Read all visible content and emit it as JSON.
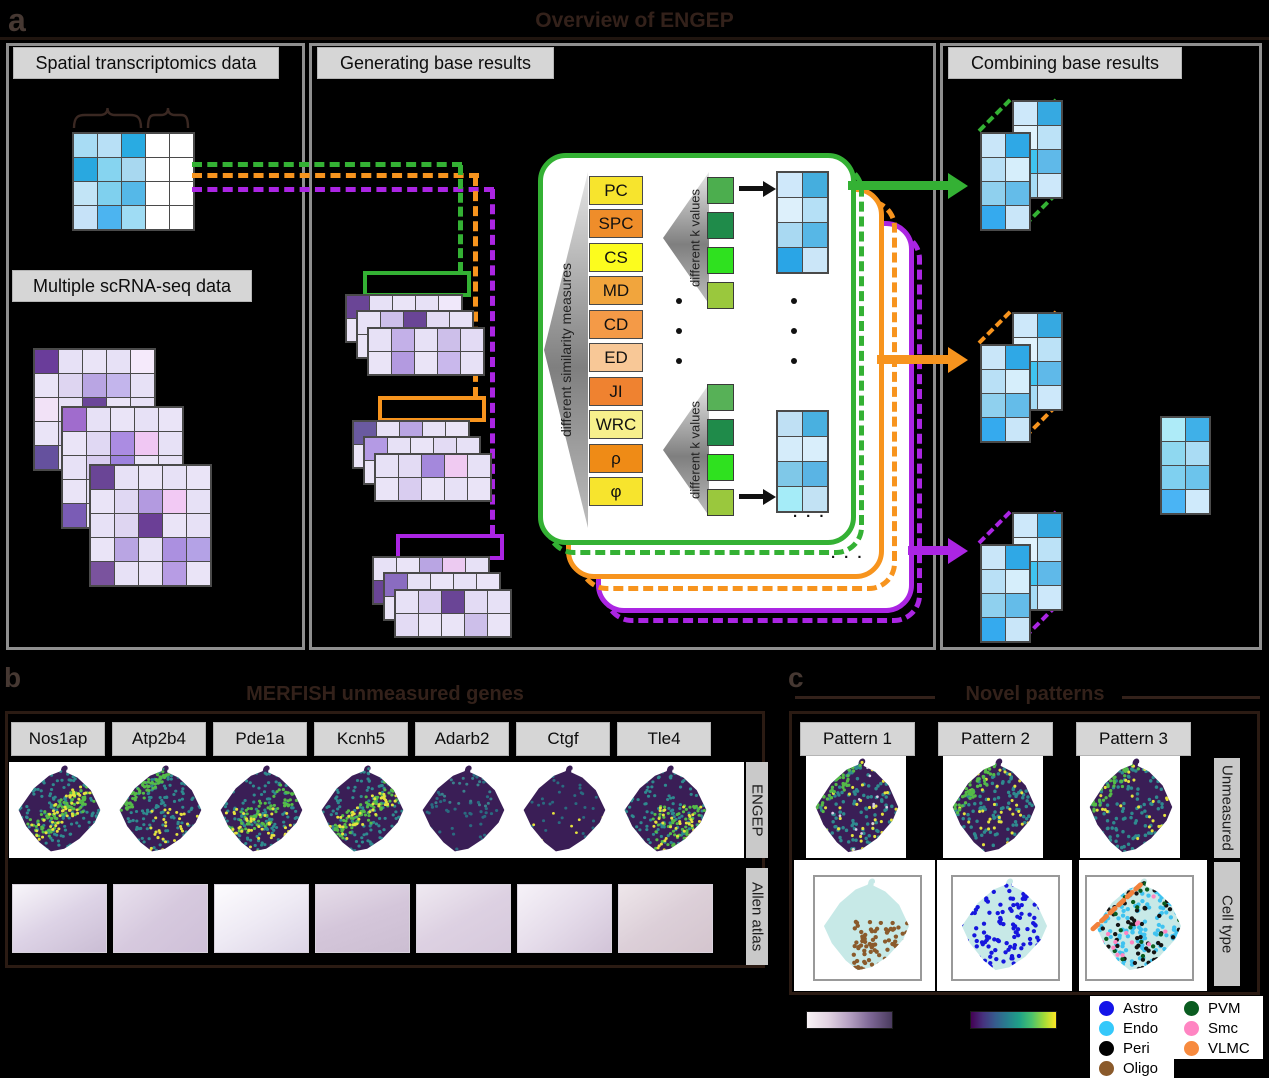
{
  "figure": {
    "tag_a": "a",
    "tag_b": "b",
    "tag_c": "c",
    "title": "Overview of ENGEP"
  },
  "colors": {
    "green": "#34b134",
    "orange": "#f7941e",
    "purple": "#ab25e3",
    "black": "#111111"
  },
  "panel_a": {
    "spatial_label": "Spatial transcriptomics data",
    "scrna_label": "Multiple scRNA-seq data",
    "generating_label": "Generating base results",
    "combining_label": "Combining base results",
    "similarity_label": "different similarity measures",
    "k_label": "different k values",
    "ellipsis": "· · ·",
    "measures": [
      {
        "label": "PC",
        "color": "#f7e42d"
      },
      {
        "label": "SPC",
        "color": "#ef8d2a"
      },
      {
        "label": "CS",
        "color": "#fcfc1e"
      },
      {
        "label": "MD",
        "color": "#f1a53d"
      },
      {
        "label": "CD",
        "color": "#f49a47"
      },
      {
        "label": "ED",
        "color": "#f8c897"
      },
      {
        "label": "JI",
        "color": "#ef8230"
      },
      {
        "label": "WRC",
        "color": "#f7f08c"
      },
      {
        "label": "ρ",
        "color": "#ef8b16"
      },
      {
        "label": "φ",
        "color": "#f7e42d"
      }
    ],
    "k_colors1": [
      "#4cae4e",
      "#1f8b4a",
      "#2fe11f",
      "#9ac83d"
    ],
    "k_colors2": [
      "#57b157",
      "#1f8b4a",
      "#2fe11f",
      "#9ac83d"
    ],
    "spatial_grid": [
      [
        "#a8dcf4",
        "#b8e0f6",
        "#29abe2",
        "#ffffff",
        "#ffffff"
      ],
      [
        "#29a8e0",
        "#86d4f0",
        "#a8d8f0",
        "#ffffff",
        "#ffffff"
      ],
      [
        "#c2e4f6",
        "#7fd0ee",
        "#55b8e8",
        "#ffffff",
        "#ffffff"
      ],
      [
        "#c6e2f8",
        "#4cb4f0",
        "#9fdcf4",
        "#ffffff",
        "#ffffff"
      ]
    ],
    "scrna_grids": [
      [
        [
          "#6a3d9a",
          "#e7e1f6",
          "#eae4f7",
          "#e7e1f6",
          "#f5eafb"
        ],
        [
          "#eae4f7",
          "#ded5f1",
          "#b9a5e3",
          "#c3b5ec",
          "#e7e1f6"
        ],
        [
          "#f2e2f7",
          "#e7e1f6",
          "#6b4699",
          "#eae4f7",
          "#e7e1f6"
        ],
        [
          "#eae4f7",
          "#ded5f1",
          "#e7e1f6",
          "#eae4f7",
          "#e7e1f6"
        ],
        [
          "#65519e",
          "#e7e1f6",
          "#ded5f1",
          "#eae4f7",
          "#e7e1f6"
        ]
      ],
      [
        [
          "#a06ccd",
          "#e7e1f6",
          "#eae4f7",
          "#e7e1f6",
          "#eae4f7"
        ],
        [
          "#eae4f7",
          "#e0d8f3",
          "#ab8ce2",
          "#f0c7f3",
          "#e7e1f6"
        ],
        [
          "#e7e1f6",
          "#d9cdf0",
          "#9d82de",
          "#eae4f7",
          "#e7e1f6"
        ],
        [
          "#eae4f7",
          "#e7e1f6",
          "#e0d8f3",
          "#eae4f7",
          "#ded5f1"
        ],
        [
          "#7a5cb5",
          "#eae4f7",
          "#e7e1f6",
          "#e0d8f3",
          "#eae4f7"
        ]
      ],
      [
        [
          "#6a4596",
          "#e7e1f6",
          "#eae4f7",
          "#e7e1f6",
          "#eae4f7"
        ],
        [
          "#eae4f7",
          "#e0d8f3",
          "#b39ae0",
          "#f2c9f4",
          "#e7e1f6"
        ],
        [
          "#e7e1f6",
          "#ded5f1",
          "#6b3f96",
          "#eae4f7",
          "#e7e1f6"
        ],
        [
          "#eae4f7",
          "#b9a5e3",
          "#e7e1f6",
          "#ab90e0",
          "#b4a2e6"
        ],
        [
          "#7a539e",
          "#e7e1f6",
          "#eae4f7",
          "#b79ce4",
          "#eae4f7"
        ]
      ]
    ],
    "gen_groups": {
      "green": [
        [
          [
            "#6a4596",
            "#e7e1f6",
            "#eae4f7",
            "#e7e1f6",
            "#f0e8fa"
          ],
          [
            "#eae4f7",
            "#d9cdf0",
            "#7a5cb5",
            "#e7e1f6",
            "#eae4f7"
          ]
        ],
        [
          [
            "#e7e1f6",
            "#cdbfea",
            "#6a4596",
            "#e3dbf4",
            "#e7e1f6"
          ],
          [
            "#eae4f7",
            "#b9a5e3",
            "#e7e1f6",
            "#d3c5ee",
            "#eae4f7"
          ]
        ],
        [
          [
            "#e7e1f6",
            "#c3b0e8",
            "#e7e1f6",
            "#cdbfea",
            "#e3dbf4"
          ],
          [
            "#eae4f7",
            "#b39ae0",
            "#eae4f7",
            "#c9b8ec",
            "#e7e1f6"
          ]
        ]
      ],
      "orange": [
        [
          [
            "#6a5aa0",
            "#e7e1f6",
            "#b9a5e3",
            "#e7e1f6",
            "#eae4f7"
          ],
          [
            "#eae4f7",
            "#e3dbf4",
            "#b09ae0",
            "#eae4f7",
            "#e7e1f6"
          ]
        ],
        [
          [
            "#b49ae4",
            "#e7e1f6",
            "#eae4f7",
            "#e3dbf4",
            "#e7e1f6"
          ],
          [
            "#eae4f7",
            "#e7e1f6",
            "#e3dbf4",
            "#eae4f7",
            "#eae4f7"
          ]
        ],
        [
          [
            "#e7e1f6",
            "#e3dbf4",
            "#a488dc",
            "#f0caf2",
            "#e7e1f6"
          ],
          [
            "#eae4f7",
            "#d9cdf0",
            "#eae4f7",
            "#e7e1f6",
            "#eae4f7"
          ]
        ]
      ],
      "purple": [
        [
          [
            "#e7e1f6",
            "#eae4f7",
            "#b9a5e3",
            "#eccaf1",
            "#e7e1f6"
          ],
          [
            "#6a4596",
            "#e3dbf4",
            "#eae4f7",
            "#e7e1f6",
            "#eae4f7"
          ]
        ],
        [
          [
            "#8a6cc0",
            "#e7e1f6",
            "#eae4f7",
            "#e7e1f6",
            "#eae4f7"
          ],
          [
            "#eae4f7",
            "#e3dbf4",
            "#6a4596",
            "#e7e1f6",
            "#eae4f7"
          ]
        ],
        [
          [
            "#e7e1f6",
            "#d9cdf0",
            "#6a4596",
            "#e3dbf4",
            "#e7e1f6"
          ],
          [
            "#e3dbf4",
            "#eae4f7",
            "#eae4f7",
            "#cdbfea",
            "#eae4f7"
          ]
        ]
      ]
    },
    "result_grids": [
      [
        [
          "#cfe8fa",
          "#45aede"
        ],
        [
          "#ddf0fb",
          "#b5e0f6"
        ],
        [
          "#a9d9f2",
          "#57b7e6"
        ],
        [
          "#2aa5e6",
          "#cbe6f8"
        ]
      ],
      [
        [
          "#bfe0f4",
          "#49b0e0"
        ],
        [
          "#d5ecfa",
          "#d9eefb"
        ],
        [
          "#7fc8e8",
          "#5ab4e4"
        ],
        [
          "#a5ecf8",
          "#c2e2f4"
        ]
      ]
    ],
    "combine": {
      "back": [
        [
          "#cde8fa",
          "#36a9e1"
        ],
        [
          "#e0f2fc",
          "#bce2f7"
        ],
        [
          "#3fc4f0",
          "#5fb9e9"
        ],
        [
          "#a7dcf5",
          "#cde8fa"
        ]
      ],
      "front": [
        [
          "#c9e6f9",
          "#2fa8e6"
        ],
        [
          "#b9e0f6",
          "#d6eefb"
        ],
        [
          "#8fd0ee",
          "#64bce9"
        ],
        [
          "#35aaee",
          "#c9e6f9"
        ]
      ],
      "standalone": [
        [
          "#aeebf8",
          "#3fb0e8"
        ],
        [
          "#8fd8f0",
          "#aadcf4"
        ],
        [
          "#7fd0f0",
          "#6cc4ec"
        ],
        [
          "#4ab4f4",
          "#cfeafb"
        ]
      ]
    }
  },
  "panel_b": {
    "title": "MERFISH unmeasured genes",
    "genes": [
      {
        "name": "Nos1ap"
      },
      {
        "name": "Atp2b4"
      },
      {
        "name": "Pde1a"
      },
      {
        "name": "Kcnh5"
      },
      {
        "name": "Adarb2"
      },
      {
        "name": "Ctgf"
      },
      {
        "name": "Tle4"
      }
    ],
    "row1_label": "ENGEP",
    "row2_label": "Allen atlas"
  },
  "panel_c": {
    "title": "Novel patterns",
    "patterns": [
      {
        "name": "Pattern 1"
      },
      {
        "name": "Pattern 2"
      },
      {
        "name": "Pattern 3"
      }
    ],
    "row1_label": "Unmeasured",
    "row2_label": "Cell type"
  },
  "legend": {
    "items": [
      {
        "label": "Astro",
        "color": "#1414e8"
      },
      {
        "label": "Endo",
        "color": "#35c8fa"
      },
      {
        "label": "Peri",
        "color": "#000000"
      },
      {
        "label": "Oligo",
        "color": "#8a5a2b"
      },
      {
        "label": "PVM",
        "color": "#0a5c20"
      },
      {
        "label": "Smc",
        "color": "#ff85c2"
      },
      {
        "label": "VLMC",
        "color": "#f78a3e"
      }
    ]
  },
  "colorbars": {
    "expression": [
      "#f9f3f6",
      "#e2d3e2",
      "#b5a0c2",
      "#7c6694",
      "#4a3b5f"
    ],
    "viridis": [
      "#440154",
      "#46327e",
      "#365c8d",
      "#277f8e",
      "#1fa187",
      "#4ac16d",
      "#a0da39",
      "#fde725"
    ]
  },
  "maps": {
    "engep": [
      {
        "seed": 1,
        "base": "#3a1e56",
        "layers": [
          {
            "c": "#2f8a8f",
            "n": 200,
            "rg": "all",
            "r": 1.7
          },
          {
            "c": "#55bb48",
            "n": 90,
            "rg": "diag",
            "r": 1.7
          },
          {
            "c": "#e5e33e",
            "n": 60,
            "rg": "diag",
            "r": 1.6
          }
        ]
      },
      {
        "seed": 2,
        "base": "#3a1e56",
        "layers": [
          {
            "c": "#2f8a8f",
            "n": 200,
            "rg": "all",
            "r": 1.7
          },
          {
            "c": "#55bb48",
            "n": 80,
            "rg": "edgeTL",
            "r": 1.7
          },
          {
            "c": "#e5e33e",
            "n": 50,
            "rg": "lowerRight",
            "r": 1.6
          }
        ]
      },
      {
        "seed": 3,
        "base": "#3a1e56",
        "layers": [
          {
            "c": "#2f8a8f",
            "n": 190,
            "rg": "all",
            "r": 1.7
          },
          {
            "c": "#55bb48",
            "n": 80,
            "rg": "diag",
            "r": 1.7
          },
          {
            "c": "#e5e33e",
            "n": 55,
            "rg": "lower",
            "r": 1.6
          }
        ]
      },
      {
        "seed": 4,
        "base": "#3a1e56",
        "layers": [
          {
            "c": "#2f8a8f",
            "n": 190,
            "rg": "all",
            "r": 1.7
          },
          {
            "c": "#55bb48",
            "n": 85,
            "rg": "diag",
            "r": 1.7
          },
          {
            "c": "#e5e33e",
            "n": 50,
            "rg": "diag",
            "r": 1.6
          }
        ]
      },
      {
        "seed": 5,
        "base": "#3a1e56",
        "layers": [
          {
            "c": "#2a6a80",
            "n": 70,
            "rg": "all",
            "r": 1.7
          },
          {
            "c": "#3a7f8c",
            "n": 35,
            "rg": "upper",
            "r": 1.6
          }
        ]
      },
      {
        "seed": 6,
        "base": "#3a1e56",
        "layers": [
          {
            "c": "#2a6a80",
            "n": 45,
            "rg": "all",
            "r": 1.6
          },
          {
            "c": "#e5e33e",
            "n": 10,
            "rg": "lower",
            "r": 1.5
          }
        ]
      },
      {
        "seed": 7,
        "base": "#3a1e56",
        "layers": [
          {
            "c": "#2f8a8f",
            "n": 140,
            "rg": "all",
            "r": 1.7
          },
          {
            "c": "#55bb48",
            "n": 70,
            "rg": "lowerRight",
            "r": 1.7
          },
          {
            "c": "#e5e33e",
            "n": 55,
            "rg": "lowerRight",
            "r": 1.6
          }
        ]
      }
    ],
    "patterns": [
      {
        "seed": 11,
        "base": "#3a1e56",
        "layers": [
          {
            "c": "#2f8a8f",
            "n": 170,
            "rg": "all",
            "r": 1.8
          },
          {
            "c": "#e5e33e",
            "n": 55,
            "rg": "all",
            "r": 1.6
          },
          {
            "c": "#55bb48",
            "n": 45,
            "rg": "edgeTL",
            "r": 1.7
          },
          {
            "c": "#d8d0e8",
            "n": 18,
            "rg": "all",
            "r": 1.4
          }
        ]
      },
      {
        "seed": 12,
        "base": "#3a1e56",
        "layers": [
          {
            "c": "#2f8a8f",
            "n": 160,
            "rg": "all",
            "r": 1.8
          },
          {
            "c": "#e5e33e",
            "n": 60,
            "rg": "all",
            "r": 1.6
          },
          {
            "c": "#55bb48",
            "n": 55,
            "rg": "edgeTL",
            "r": 1.7
          }
        ]
      },
      {
        "seed": 13,
        "base": "#3a1e56",
        "layers": [
          {
            "c": "#2f8a8f",
            "n": 170,
            "rg": "all",
            "r": 1.8
          },
          {
            "c": "#e5e33e",
            "n": 42,
            "rg": "all",
            "r": 1.6
          },
          {
            "c": "#55bb48",
            "n": 40,
            "rg": "edgeTL",
            "r": 1.7
          }
        ]
      }
    ],
    "celltype": [
      {
        "seed": 21,
        "base": "#c7e9e7",
        "layers": [
          {
            "c": "#8a5a2b",
            "n": 120,
            "rg": "lowerRight",
            "r": 2.2
          }
        ]
      },
      {
        "seed": 22,
        "base": "#c7e9e7",
        "layers": [
          {
            "c": "#1616dd",
            "n": 150,
            "rg": "all",
            "r": 2.2
          }
        ]
      },
      {
        "seed": 23,
        "base": "#c7e9e7",
        "layers": [
          {
            "c": "#3fc3f0",
            "n": 150,
            "rg": "all",
            "r": 2.2
          },
          {
            "c": "#141414",
            "n": 75,
            "rg": "all",
            "r": 2.2
          },
          {
            "c": "#0a5c20",
            "n": 32,
            "rg": "all",
            "r": 2.2
          },
          {
            "c": "#ff85c2",
            "n": 20,
            "rg": "all",
            "r": 2.2
          }
        ],
        "arc": "#f2813c"
      }
    ],
    "allen": [
      {
        "deg": 150,
        "cs": [
          "#f8f6fa",
          "#ddd3e6",
          "#cabdd4"
        ]
      },
      {
        "deg": 140,
        "cs": [
          "#e9e1ee",
          "#d6c9de",
          "#cfc0d8"
        ]
      },
      {
        "deg": 150,
        "cs": [
          "#fdfcfe",
          "#eeeaf4",
          "#dcd4e6"
        ]
      },
      {
        "deg": 160,
        "cs": [
          "#e6dde9",
          "#d4c6da",
          "#ccbed2"
        ]
      },
      {
        "deg": 150,
        "cs": [
          "#efe9f1",
          "#ddd1e2",
          "#d6c9dc"
        ]
      },
      {
        "deg": 140,
        "cs": [
          "#f6f2f8",
          "#e5dcea",
          "#d2c4d8"
        ]
      },
      {
        "deg": 145,
        "cs": [
          "#eee6ea",
          "#dccfd8",
          "#d4c5ce"
        ]
      }
    ]
  }
}
